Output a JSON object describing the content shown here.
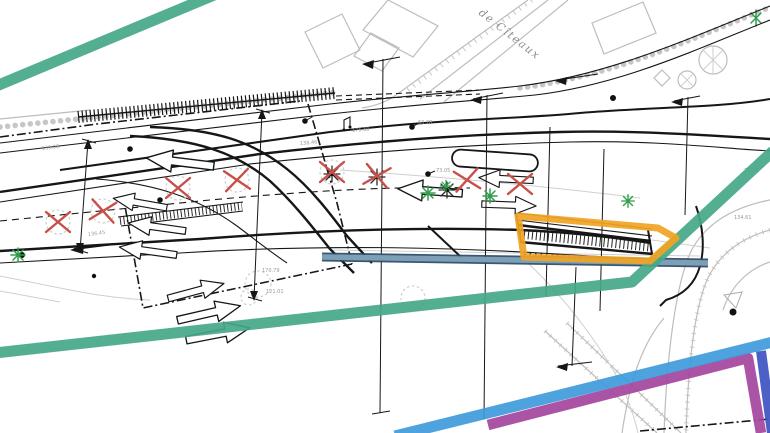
{
  "plan": {
    "street_label": "de Cîteaux",
    "drawing_type": "roadway site plan"
  },
  "colors": {
    "annotation-green": "#45a788",
    "annotation-orange": "#f0a424",
    "annotation-blue": "#3f9bdc",
    "annotation-purple": "#a4459e",
    "annotation-indigo": "#3d53c0",
    "steel-fill": "#83a6bd",
    "steel-border": "#2a4a66",
    "marker-red": "#c9504a",
    "tree-green": "#2e9e4b",
    "line-black": "#161616",
    "line-gray": "#bdbdbd",
    "text-gray": "#9a9a9a"
  },
  "elevation_labels": [
    {
      "text": "139.08"
    },
    {
      "text": "136.45"
    },
    {
      "text": "138.46"
    },
    {
      "text": "176.48"
    },
    {
      "text": "63.28"
    },
    {
      "text": "73.05"
    },
    {
      "text": "170.79"
    },
    {
      "text": "121.01"
    },
    {
      "text": "75.08"
    },
    {
      "text": "134.61"
    }
  ],
  "symbols": {
    "tree-removal-marker": "red X cross",
    "new-tree-marker": "green asterisk",
    "existing-tree-marker": "dark asterisk",
    "tree-canopy-icon": "hatched circle",
    "survey-point": "black dot",
    "lane-arrow": "white outlined arrow",
    "boundary-line": "black dash-dot line",
    "vegetation-band": "dense black hatch strip"
  }
}
